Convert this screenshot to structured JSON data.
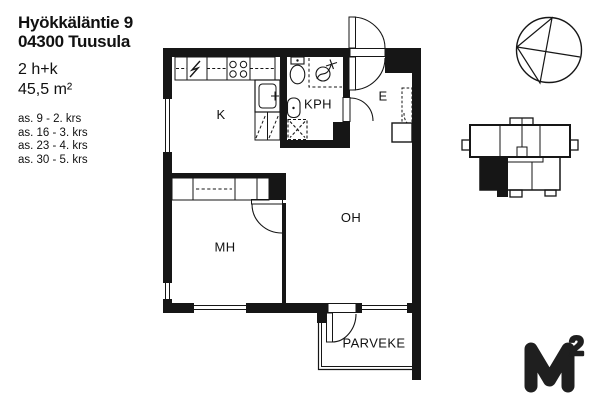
{
  "header": {
    "street": "Hyökkäläntie 9",
    "city": "04300 Tuusula"
  },
  "apartment": {
    "layout": "2 h+k",
    "area": "45,5 m²"
  },
  "floor_list": [
    "as. 9 - 2. krs",
    "as. 16 - 3. krs",
    "as. 23 - 4. krs",
    "as. 30 - 5. krs"
  ],
  "room_labels": {
    "kitchen": "K",
    "bathroom": "KPH",
    "entry": "E",
    "living_room": "OH",
    "bedroom": "MH",
    "balcony": "PARVEKE"
  },
  "logo": {
    "letter": "M",
    "exponent": "2"
  },
  "colors": {
    "ink": "#161616",
    "text": "#111111"
  }
}
